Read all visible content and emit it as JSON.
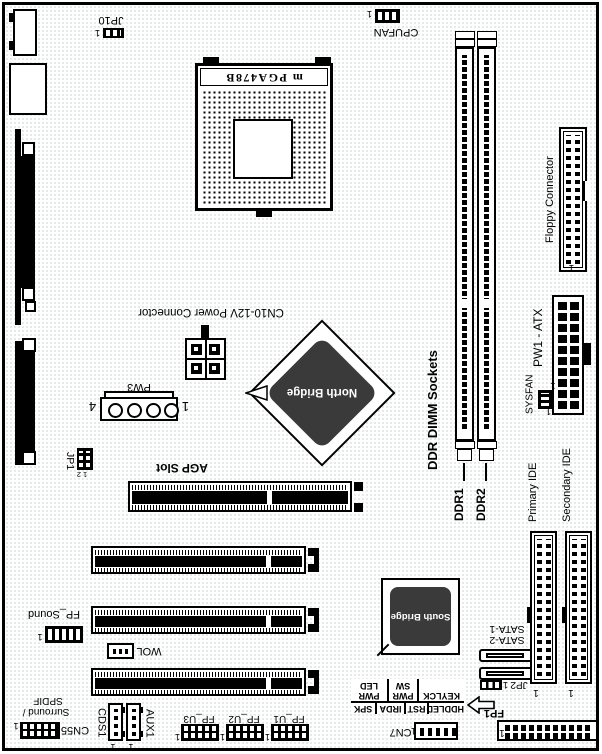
{
  "title": "Motherboard layout diagram",
  "colors": {
    "line": "#000000",
    "chip_fill": "#3a3a3a",
    "chip_text": "#ffffff",
    "board_texture": "#dde3dd",
    "label_text": "#000000"
  },
  "labels": {
    "jp10": "JP10",
    "cpufan": "CPUFAN",
    "cpu_socket": "m PGA478B",
    "cn10_power": "CN10-12V Power Connector",
    "pw3": "PW3",
    "jp1": "JP1",
    "agp_slot": "AGP Slot",
    "north_bridge": "North Bridge",
    "ddr_sockets": "DDR DIMM Sockets",
    "ddr1": "DDR1",
    "ddr2": "DDR2",
    "floppy": "Floppy Connector",
    "pw1_atx": "PW1 - ATX",
    "sysfan": "SYSFAN",
    "primary_ide": "Primary IDE",
    "secondary_ide": "Secondary IDE",
    "sata1": "SATA-1",
    "sata2": "SATA-2",
    "jp2": "JP2",
    "south_bridge": "South Bridge",
    "fp1": "FP1",
    "cn7": "CN7",
    "fp_u1": "FP_U1",
    "fp_u2": "FP_U2",
    "fp_u3": "FP_U3",
    "wol": "WOL",
    "fp_sound": "FP_Sound",
    "cds1": "CDS1",
    "aux1": "AUX1",
    "cn55": "CN55",
    "surround_line1": "Surround /",
    "surround_line2": "SPDIF"
  },
  "pin_markers": {
    "p1": "1",
    "p2": "2",
    "p4": "4",
    "jp1_pins": "1 2"
  },
  "fp_table": {
    "row1": [
      "HDDLED",
      "RST",
      "IRDA",
      "SPK"
    ],
    "row2": [
      {
        "l1": "KEYLCK",
        "l2": ""
      },
      {
        "l1": "PWR",
        "l2": "SW"
      },
      {
        "l1": "PWR",
        "l2": "LED"
      }
    ]
  }
}
